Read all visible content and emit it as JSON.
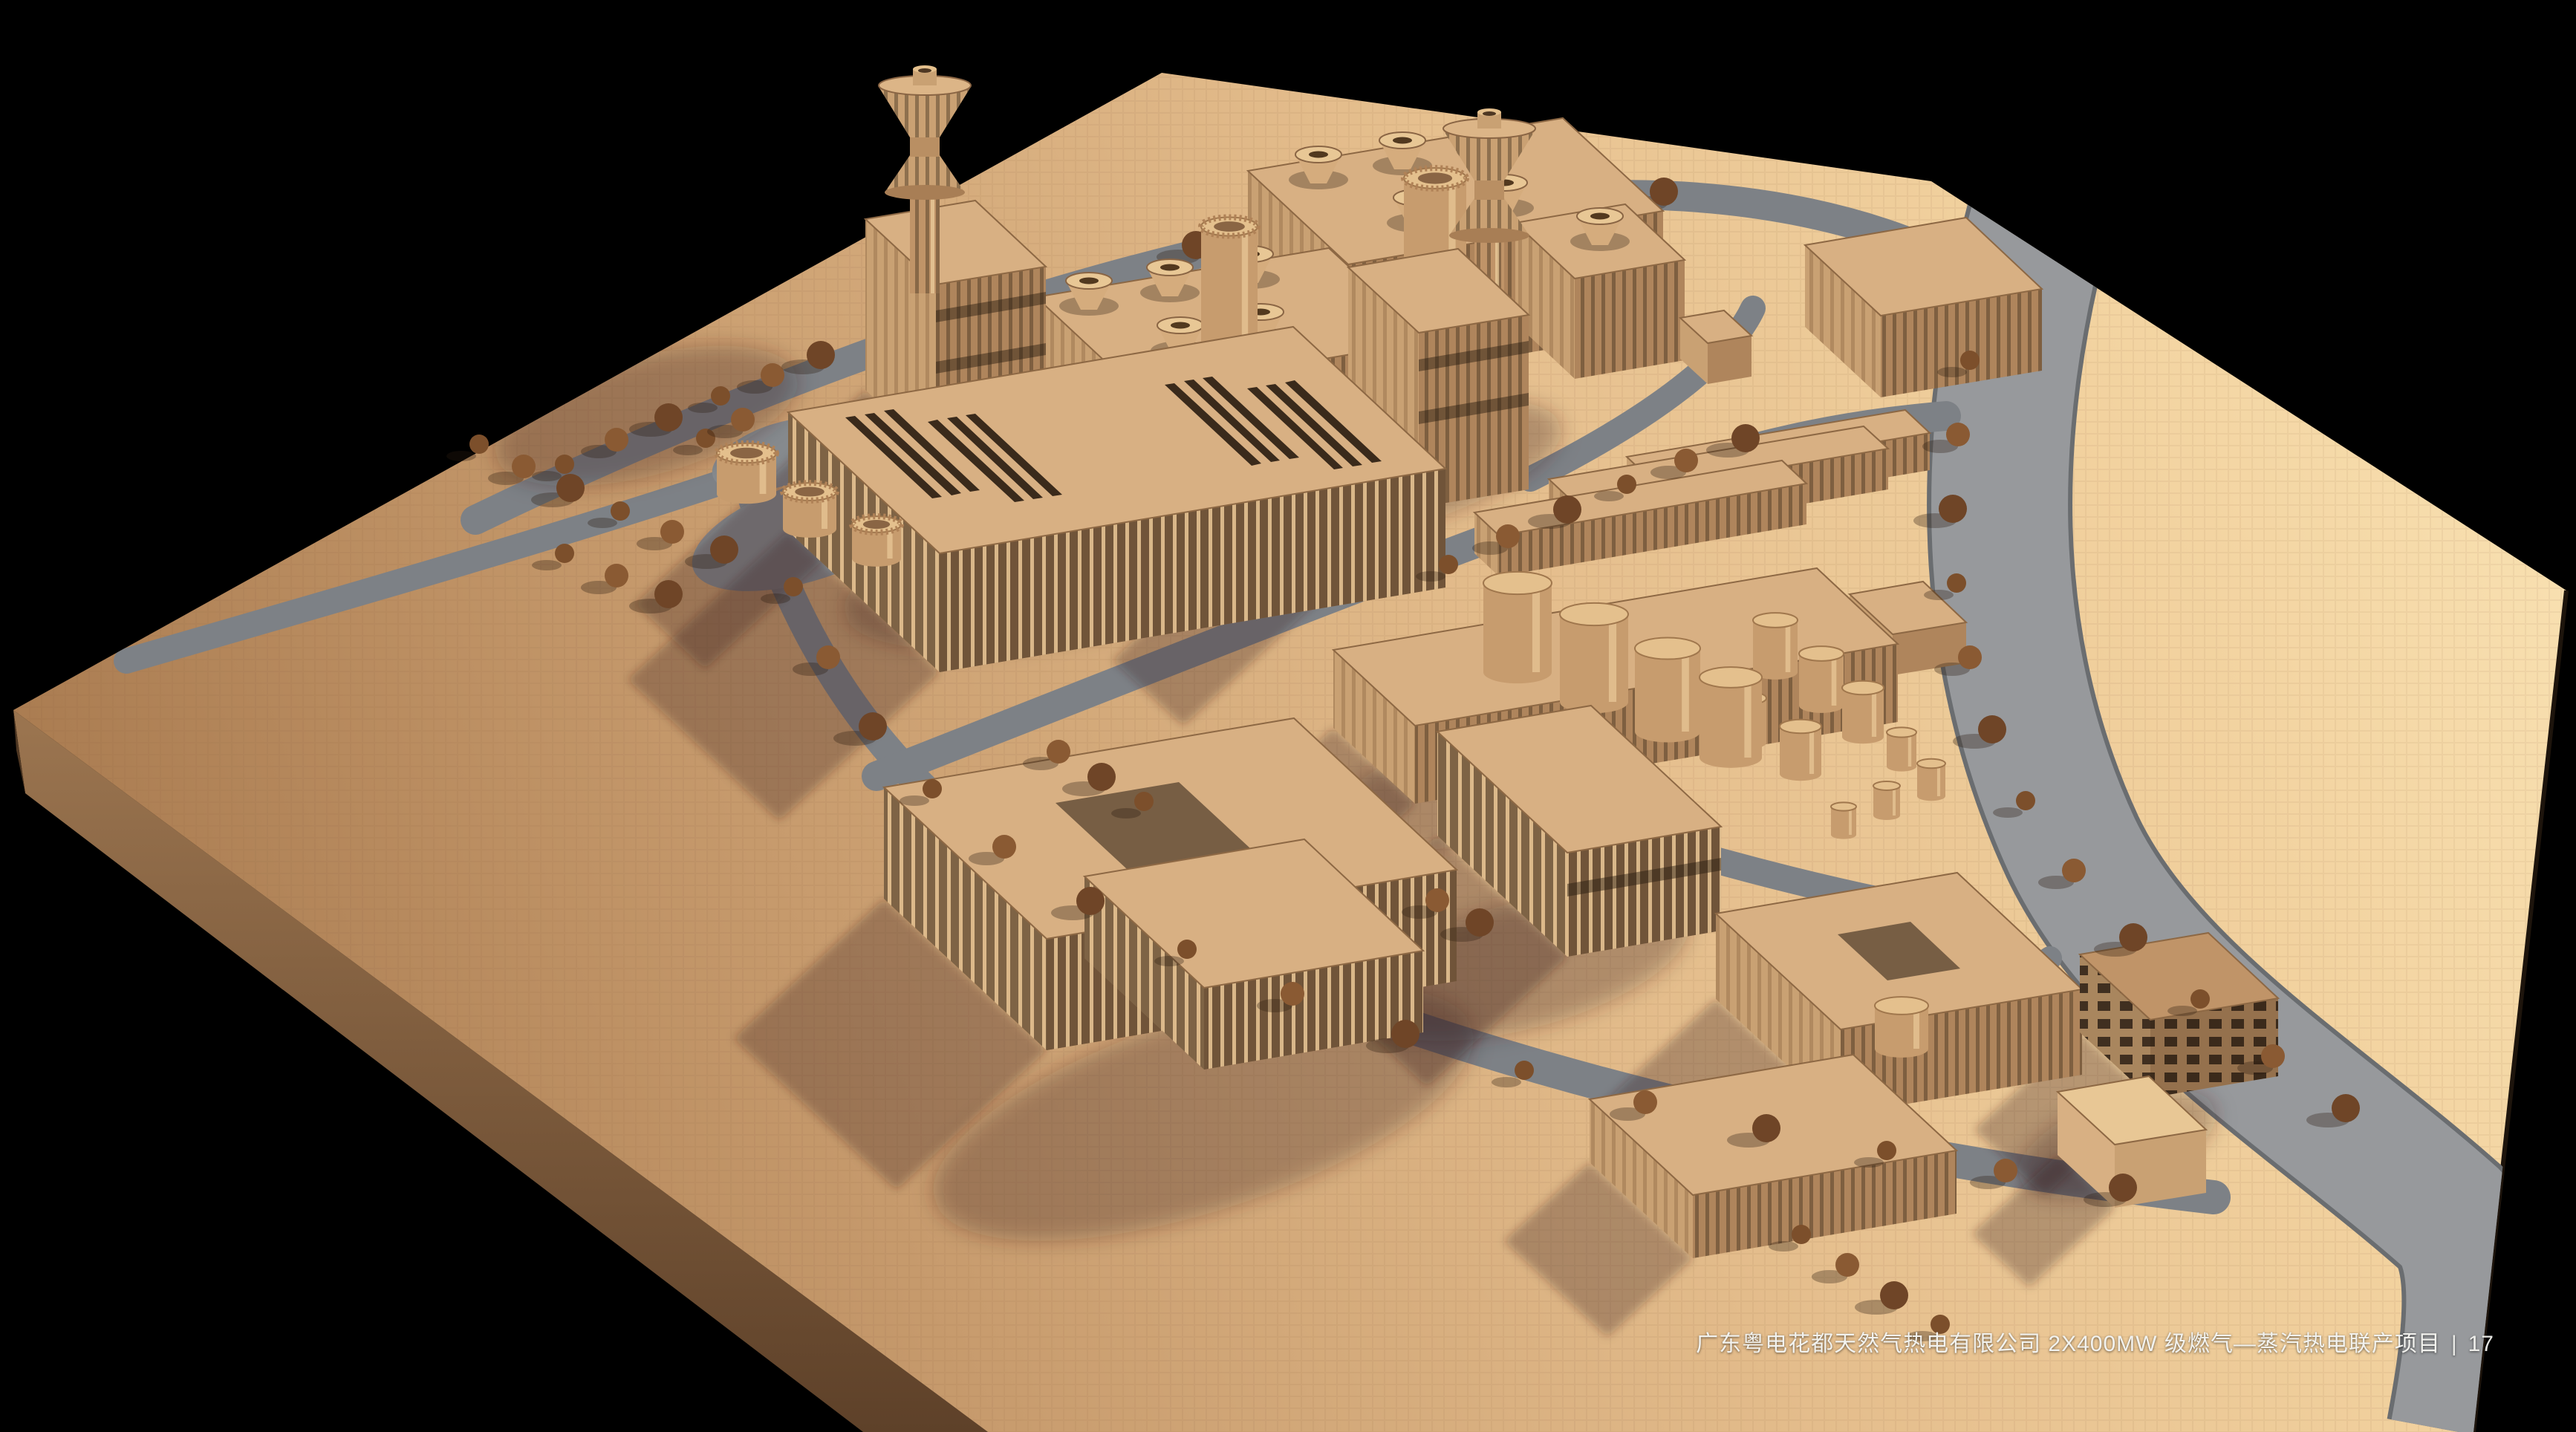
{
  "caption": {
    "project_title": "广东粤电花都天然气热电有限公司 2X400MW 级燃气—蒸汽热电联产项目",
    "separator": "|",
    "page_number": "17"
  },
  "palette": {
    "background": "#000000",
    "plate_light": "#f9e2b3",
    "plate_mid": "#e4bd8c",
    "plate_dark": "#ab7d52",
    "plate_side": "#96714e",
    "plate_side_dark": "#66472f",
    "river": "#97999c",
    "road": "#7d8186",
    "building_top": "#d8b083",
    "building_lit": "#e9c694",
    "building_end": "#c9a173",
    "building_shade": "#af855c",
    "building_slot": "#3a2a1b",
    "tank": "#c79c6e",
    "tree": "#7c4f2b",
    "shadow": "rgba(58,36,20,0.30)",
    "caption_color": "#f2f2ee"
  }
}
